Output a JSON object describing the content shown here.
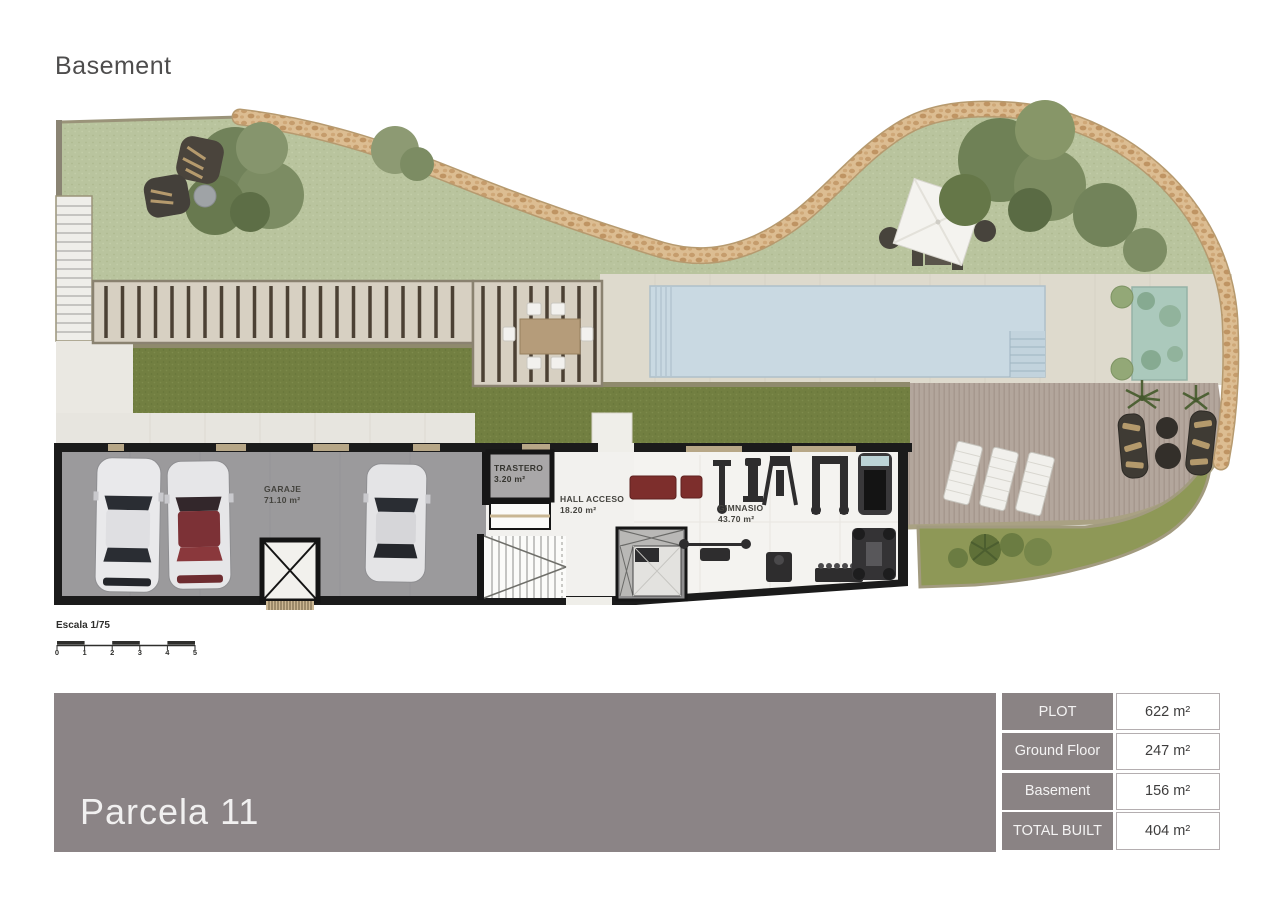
{
  "page": {
    "title": "Basement"
  },
  "plan": {
    "rooms": [
      {
        "name": "GARAJE",
        "area": "71.10 m²"
      },
      {
        "name": "TRASTERO",
        "area": "3.20 m²"
      },
      {
        "name": "HALL ACCESO",
        "area": "18.20 m²"
      },
      {
        "name": "GIMNASIO",
        "area": "43.70 m²"
      }
    ],
    "scale": {
      "label": "Escala 1/75",
      "ticks": [
        "0",
        "1",
        "2",
        "3",
        "4",
        "5"
      ]
    }
  },
  "footer": {
    "parcel_label": "Parcela 11",
    "summary": {
      "rows": [
        {
          "label": "PLOT",
          "value": "622 m²"
        },
        {
          "label": "Ground Floor",
          "value": "247 m²"
        },
        {
          "label": "Basement",
          "value": "156 m²"
        },
        {
          "label": "TOTAL BUILT",
          "value": "404 m²"
        }
      ]
    }
  },
  "palette": {
    "banner": "#8b8486",
    "table_header": "#8a8384",
    "lawn": "#b9c49e",
    "dark_grass": "#727f41",
    "pool": "#c9d9e2",
    "deck": "#b3a69c",
    "pebble": "#dcbd92",
    "wall": "#1b1b1b",
    "concrete": "#dedacd",
    "garage_floor": "#9b9a9c",
    "accent_red": "#7d2e2c"
  }
}
